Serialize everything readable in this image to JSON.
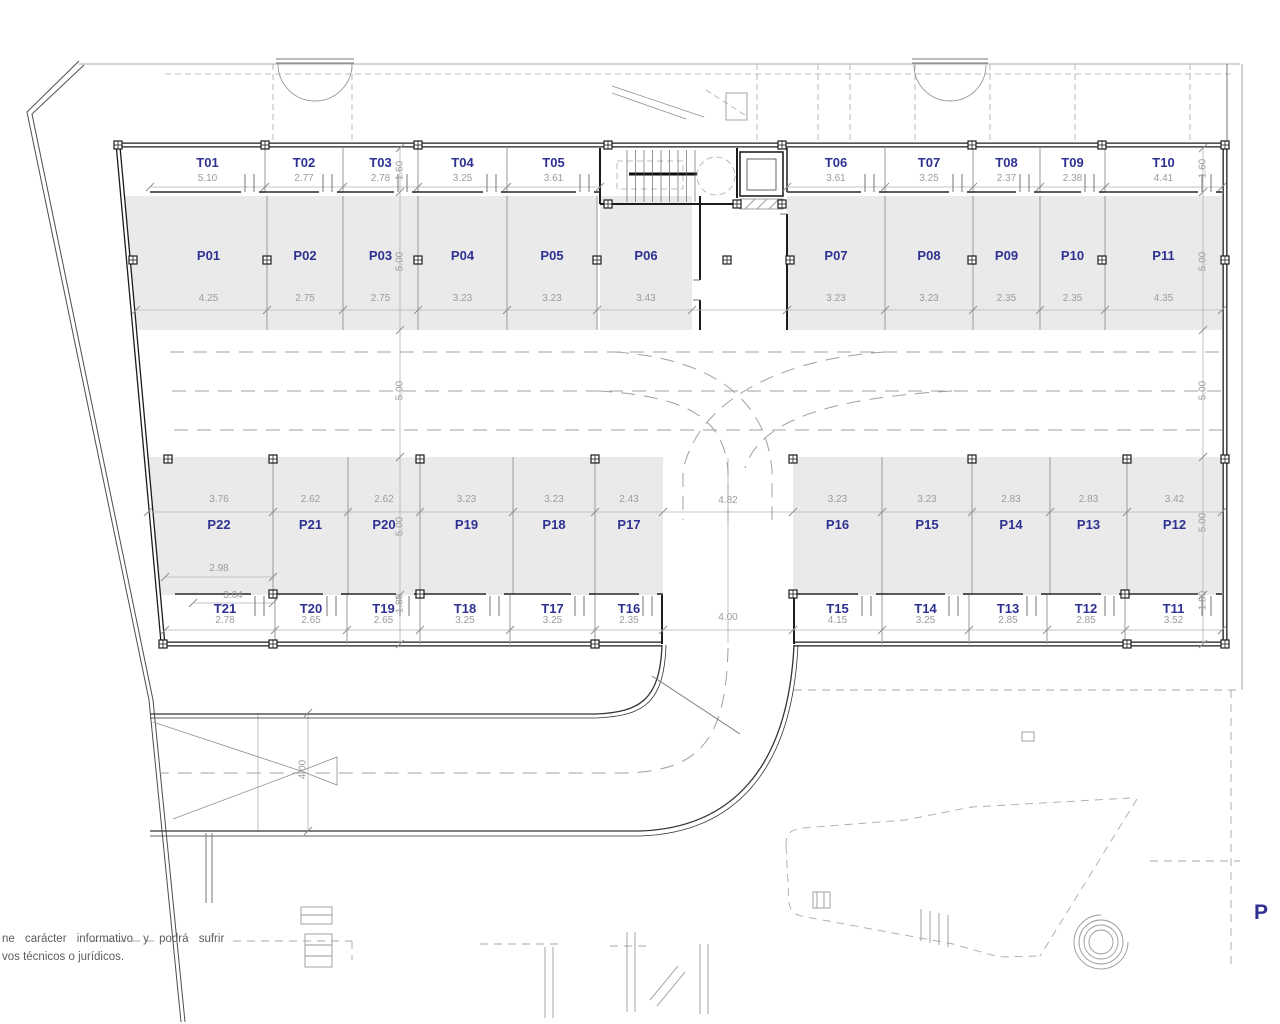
{
  "plan": {
    "level_marker": "P",
    "colors": {
      "label_blue": "#2E3192",
      "dim_gray": "#9C9C9C",
      "wall": "#1C1C1C",
      "stall_fill": "#EAEAEA"
    },
    "notes": {
      "line1": "ne carácter informativo y podrá sufrir",
      "line2": "vos técnicos o jurídicos."
    },
    "dims": {
      "left_chain": [
        "1.60",
        "5.00",
        "5.00",
        "5.00",
        "1.80"
      ],
      "right_chain": [
        "1.60",
        "5.00",
        "5.00",
        "5.00",
        "1.80"
      ],
      "center_top_gap": "4.82",
      "center_bottom_gap": "4.00",
      "ramp": "4.00"
    },
    "units": {
      "storage_top": [
        {
          "label": "T01",
          "dim": "5.10"
        },
        {
          "label": "T02",
          "dim": "2.77"
        },
        {
          "label": "T03",
          "dim": "2.78"
        },
        {
          "label": "T04",
          "dim": "3.25"
        },
        {
          "label": "T05",
          "dim": "3.61"
        },
        {
          "label": "T06",
          "dim": "3.61"
        },
        {
          "label": "T07",
          "dim": "3.25"
        },
        {
          "label": "T08",
          "dim": "2.37"
        },
        {
          "label": "T09",
          "dim": "2.38"
        },
        {
          "label": "T10",
          "dim": "4.41"
        }
      ],
      "parking_top": [
        {
          "label": "P01",
          "dim": "4.25"
        },
        {
          "label": "P02",
          "dim": "2.75"
        },
        {
          "label": "P03",
          "dim": "2.75"
        },
        {
          "label": "P04",
          "dim": "3.23"
        },
        {
          "label": "P05",
          "dim": "3.23"
        },
        {
          "label": "P06",
          "dim": "3.43"
        },
        {
          "label": "P07",
          "dim": "3.23"
        },
        {
          "label": "P08",
          "dim": "3.23"
        },
        {
          "label": "P09",
          "dim": "2.35"
        },
        {
          "label": "P10",
          "dim": "2.35"
        },
        {
          "label": "P11",
          "dim": "4.35"
        }
      ],
      "parking_bottom": [
        {
          "label": "P22",
          "dim": "3.76",
          "extra_dims": [
            "2.98",
            "3.04"
          ]
        },
        {
          "label": "P21",
          "dim": "2.62"
        },
        {
          "label": "P20",
          "dim": "2.62"
        },
        {
          "label": "P19",
          "dim": "3.23"
        },
        {
          "label": "P18",
          "dim": "3.23"
        },
        {
          "label": "P17",
          "dim": "2.43"
        },
        {
          "label": "P16",
          "dim": "3.23"
        },
        {
          "label": "P15",
          "dim": "3.23"
        },
        {
          "label": "P14",
          "dim": "2.83"
        },
        {
          "label": "P13",
          "dim": "2.83"
        },
        {
          "label": "P12",
          "dim": "3.42"
        }
      ],
      "storage_bottom": [
        {
          "label": "T21",
          "dim": "2.78"
        },
        {
          "label": "T20",
          "dim": "2.65"
        },
        {
          "label": "T19",
          "dim": "2.65"
        },
        {
          "label": "T18",
          "dim": "3.25"
        },
        {
          "label": "T17",
          "dim": "3.25"
        },
        {
          "label": "T16",
          "dim": "2.35"
        },
        {
          "label": "T15",
          "dim": "4.15"
        },
        {
          "label": "T14",
          "dim": "3.25"
        },
        {
          "label": "T13",
          "dim": "2.85"
        },
        {
          "label": "T12",
          "dim": "2.85"
        },
        {
          "label": "T11",
          "dim": "3.52"
        }
      ]
    }
  }
}
